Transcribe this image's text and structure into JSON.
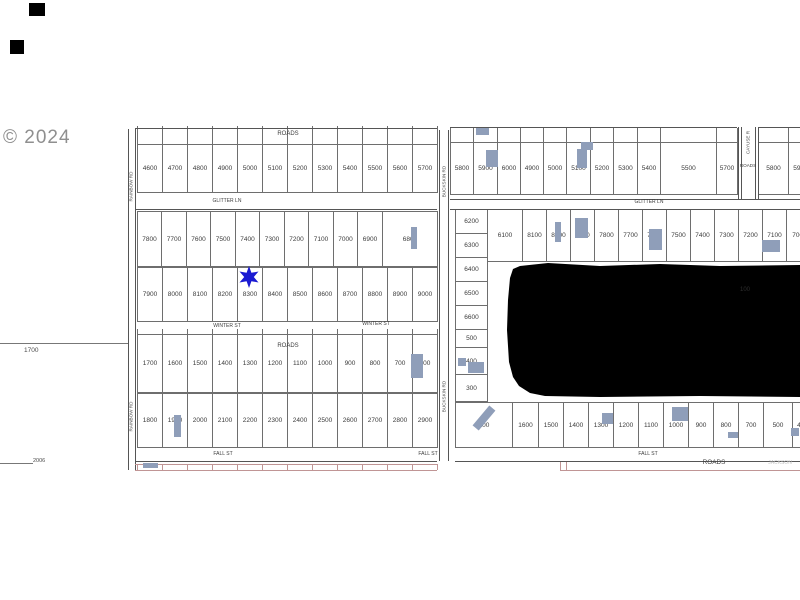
{
  "watermark": "© 2024",
  "margin": {
    "upper_label": "1700",
    "lower_label": "2006"
  },
  "roads": {
    "roads": "ROADS",
    "glitter_ln": "GLITTER LN",
    "winter_st": "WINTER ST",
    "fall_st": "FALL ST",
    "rainbow_rd": "RAINBOW RD",
    "buckskin_rd": "BUCKSKIN RD",
    "cayuse_rd": "CAYUSE R",
    "jackson": "JACKSON"
  },
  "lots": {
    "row_a": [
      "4600",
      "4700",
      "4800",
      "4900",
      "5000",
      "5100",
      "5200",
      "5300",
      "5400",
      "5500",
      "5600",
      "5700"
    ],
    "row_b1": [
      "7800",
      "7700",
      "7600",
      "7500",
      "7400",
      "7300",
      "7200",
      "7100",
      "7000",
      "6900",
      "6800"
    ],
    "row_b2": [
      "7900",
      "8000",
      "8100",
      "8200",
      "8300",
      "8400",
      "8500",
      "8600",
      "8700",
      "8800",
      "8900",
      "9000"
    ],
    "row_c1": [
      "1700",
      "1600",
      "1500",
      "1400",
      "1300",
      "1200",
      "1100",
      "1000",
      "900",
      "800",
      "700",
      "600"
    ],
    "row_c2": [
      "1800",
      "1900",
      "2000",
      "2100",
      "2200",
      "2300",
      "2400",
      "2500",
      "2600",
      "2700",
      "2800",
      "2900"
    ],
    "row_d": [
      "5800",
      "5900",
      "6000",
      "4900",
      "5000",
      "5100",
      "5200",
      "5300",
      "5400",
      "5500",
      "5700"
    ],
    "row_e": [
      "5800",
      "5900"
    ],
    "col_f": [
      "6200",
      "6300",
      "6400",
      "6500",
      "6600",
      "500",
      "400",
      "300"
    ],
    "row_f1": [
      "6100",
      "8100",
      "8000",
      "7900",
      "7800",
      "7700",
      "7600",
      "7500",
      "7400",
      "7300",
      "7200",
      "7100",
      "7000"
    ],
    "row_f2": [
      "100",
      "1600",
      "1500",
      "1400",
      "1300",
      "1200",
      "1100",
      "1000",
      "900",
      "800",
      "700",
      "500",
      "400"
    ]
  },
  "blob": {
    "label": "100"
  },
  "marker": {
    "type": "star",
    "color": "#1a1ad2"
  },
  "colors": {
    "building": "#8f9eb9",
    "road_line": "#555555",
    "red_line": "#c09595",
    "lot_text": "#3b3b3b"
  },
  "buildings": [
    {
      "x": 476,
      "y": 128,
      "w": 13,
      "h": 7
    },
    {
      "x": 486,
      "y": 150,
      "w": 12,
      "h": 17
    },
    {
      "x": 581,
      "y": 142,
      "w": 12,
      "h": 8
    },
    {
      "x": 577,
      "y": 149,
      "w": 10,
      "h": 19
    },
    {
      "x": 411,
      "y": 227,
      "w": 6,
      "h": 22
    },
    {
      "x": 555,
      "y": 222,
      "w": 6,
      "h": 20
    },
    {
      "x": 575,
      "y": 218,
      "w": 13,
      "h": 20
    },
    {
      "x": 649,
      "y": 229,
      "w": 13,
      "h": 21
    },
    {
      "x": 762,
      "y": 240,
      "w": 18,
      "h": 12
    },
    {
      "x": 458,
      "y": 358,
      "w": 8,
      "h": 8
    },
    {
      "x": 468,
      "y": 362,
      "w": 16,
      "h": 11
    },
    {
      "x": 411,
      "y": 354,
      "w": 12,
      "h": 24
    },
    {
      "x": 174,
      "y": 415,
      "w": 7,
      "h": 22
    },
    {
      "x": 480,
      "y": 405,
      "w": 8,
      "h": 26,
      "rot": 40
    },
    {
      "x": 602,
      "y": 413,
      "w": 11,
      "h": 11
    },
    {
      "x": 672,
      "y": 407,
      "w": 16,
      "h": 14
    },
    {
      "x": 728,
      "y": 432,
      "w": 10,
      "h": 6
    },
    {
      "x": 791,
      "y": 428,
      "w": 8,
      "h": 8
    },
    {
      "x": 143,
      "y": 463,
      "w": 15,
      "h": 5
    }
  ],
  "artifact_squares": [
    {
      "x": 29,
      "y": 3,
      "w": 16,
      "h": 13
    },
    {
      "x": 10,
      "y": 40,
      "w": 14,
      "h": 14
    }
  ]
}
